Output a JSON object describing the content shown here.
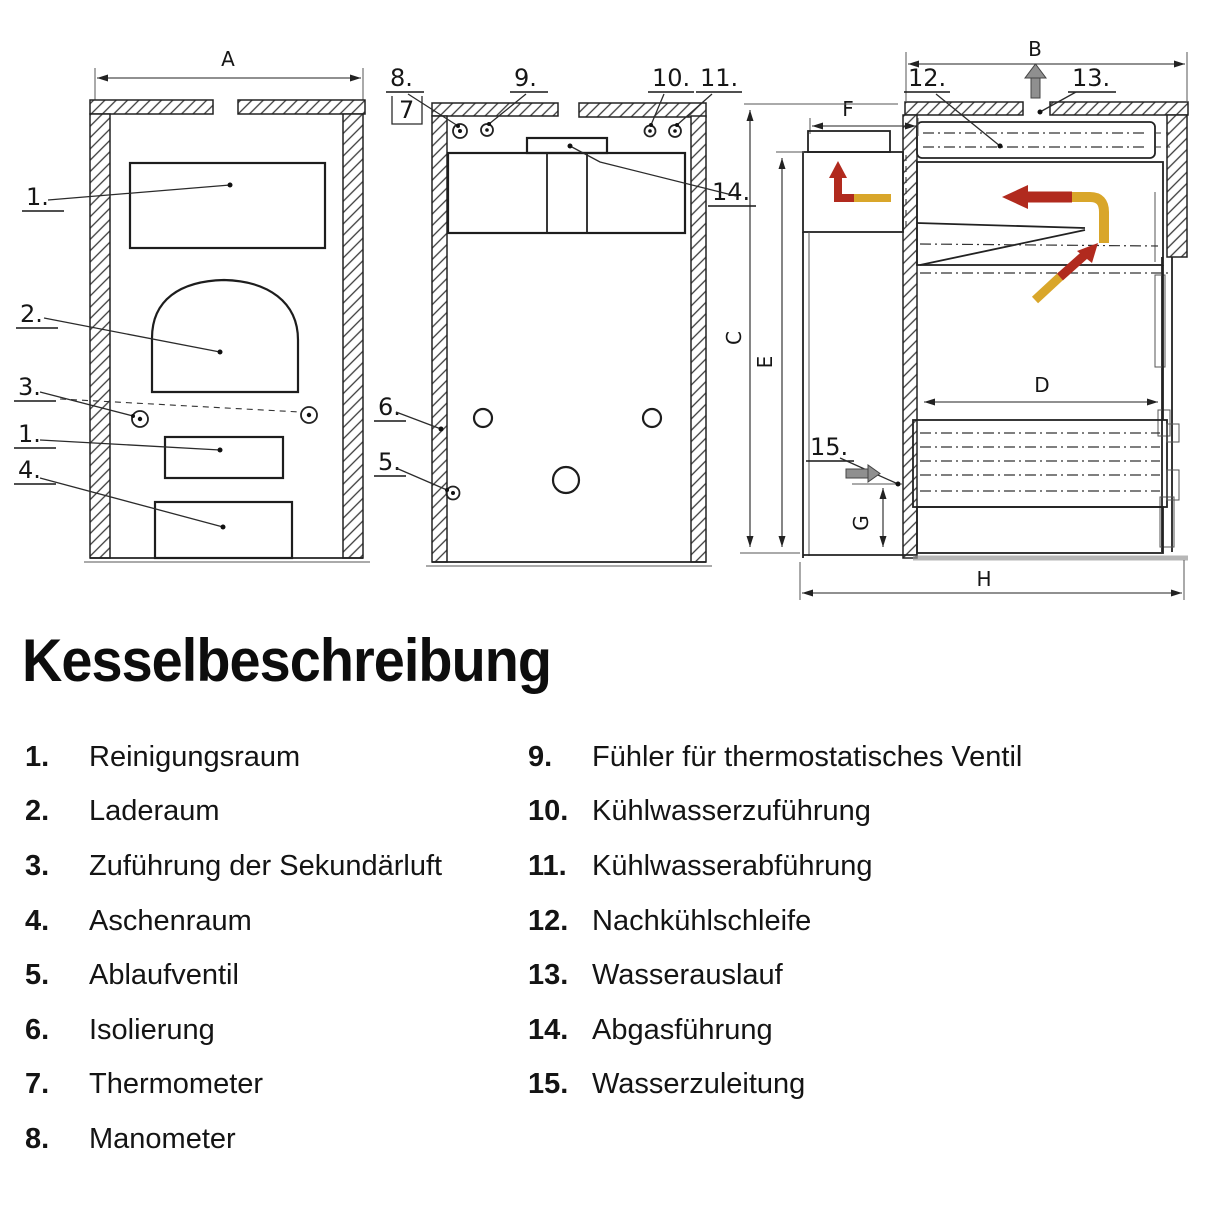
{
  "page": {
    "title": "Kesselbeschreibung",
    "background": "#ffffff"
  },
  "legend": {
    "left": [
      {
        "num": "1.",
        "label": "Reinigungsraum"
      },
      {
        "num": "2.",
        "label": "Laderaum"
      },
      {
        "num": "3.",
        "label": "Zuführung der Sekundärluft"
      },
      {
        "num": "4.",
        "label": "Aschenraum"
      },
      {
        "num": "5.",
        "label": "Ablaufventil"
      },
      {
        "num": "6.",
        "label": "Isolierung"
      },
      {
        "num": "7.",
        "label": "Thermometer"
      },
      {
        "num": "8.",
        "label": "Manometer"
      }
    ],
    "right": [
      {
        "num": "9.",
        "label": "Fühler für thermostatisches Ventil"
      },
      {
        "num": "10.",
        "label": "Kühlwasserzuführung"
      },
      {
        "num": "11.",
        "label": "Kühlwasserabführung"
      },
      {
        "num": "12.",
        "label": "Nachkühlschleife"
      },
      {
        "num": "13.",
        "label": "Wasserauslauf"
      },
      {
        "num": "14.",
        "label": "Abgasführung"
      },
      {
        "num": "15.",
        "label": "Wasserzuleitung"
      }
    ]
  },
  "diagram": {
    "dims": {
      "a": "A",
      "b": "B",
      "c": "C",
      "d": "D",
      "e": "E",
      "f": "F",
      "g": "G",
      "h": "H"
    },
    "callouts": {
      "c1": "1.",
      "c2": "2.",
      "c3": "3.",
      "c4": "4.",
      "c5": "5.",
      "c6": "6.",
      "c7": "7",
      "c8": "8.",
      "c9": "9.",
      "c10": "10.",
      "c11": "11.",
      "c12": "12.",
      "c13": "13.",
      "c14": "14.",
      "c15": "15."
    },
    "colors": {
      "flow_hot": "#b12a1e",
      "flow_warm": "#d9a62a",
      "flow_gray": "#8f8f8f",
      "ink": "#1d1d1d"
    }
  }
}
